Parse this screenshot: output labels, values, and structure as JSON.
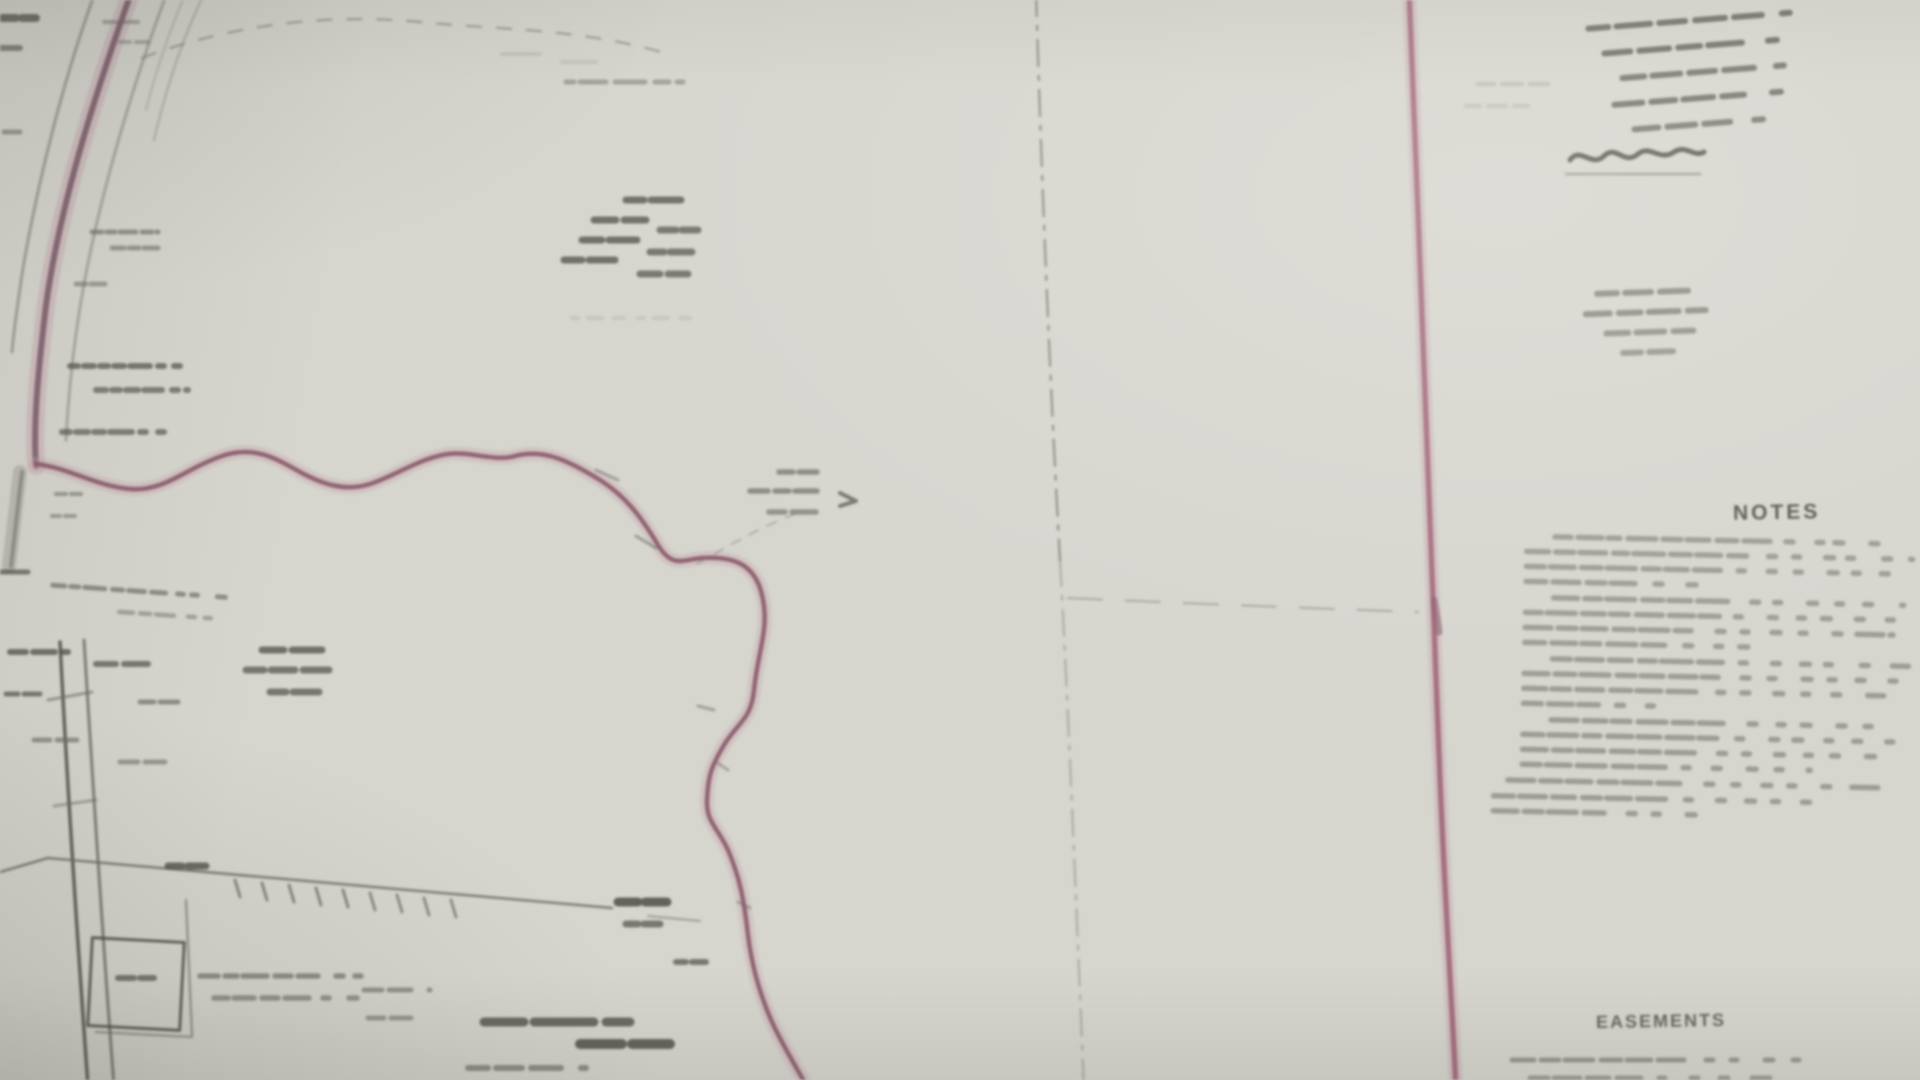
{
  "map": {
    "right_panel": {
      "notes_heading": "NOTES",
      "easements_heading": "EASEMENTS"
    }
  },
  "colors": {
    "paper": "#d6d5ce",
    "ink_dark": "#4e4e47",
    "ink": "#6e6e67",
    "ink_faint": "#9a9992",
    "road_pink": "#7e5e6b",
    "boundary_pink": "#8d5c6e",
    "border_pink": "#a4697c",
    "pink_halo": "#c8a5af",
    "dash_gray": "#83837c"
  }
}
